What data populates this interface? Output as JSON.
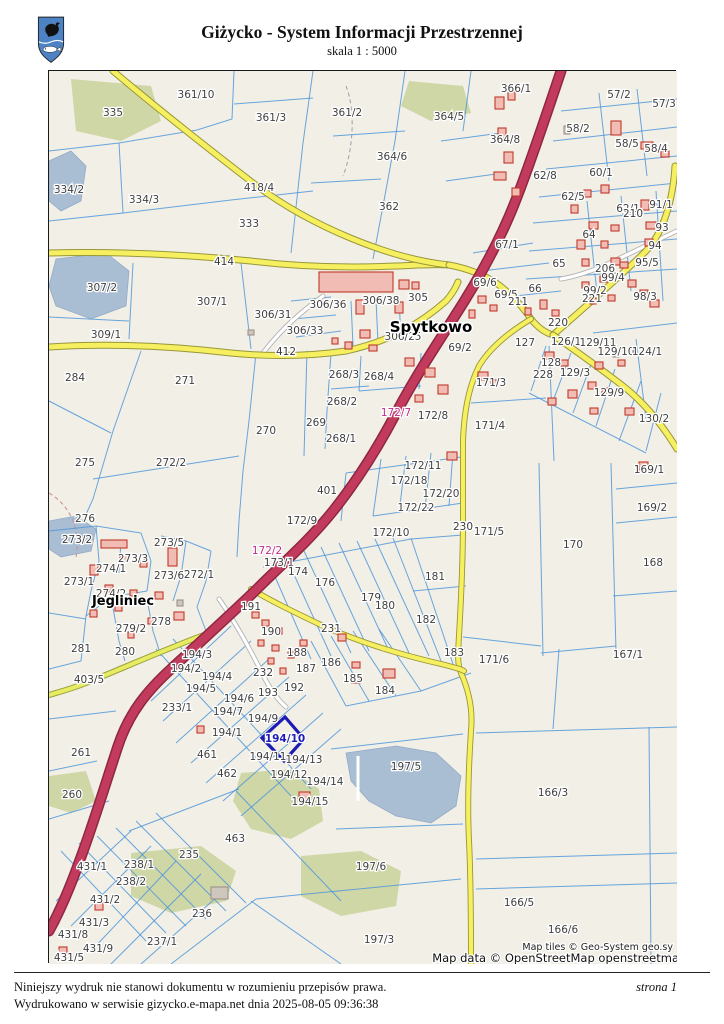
{
  "header": {
    "title": "Giżycko - System Informacji Przestrzennej",
    "scale_label": "skala 1 : 5000"
  },
  "map": {
    "place_labels": [
      [
        "Spytkowo",
        430,
        331
      ],
      [
        "Jegliniec",
        122,
        604
      ]
    ],
    "parcel_labels": [
      [
        "335",
        112,
        115
      ],
      [
        "361/10",
        195,
        97
      ],
      [
        "361/3",
        270,
        120
      ],
      [
        "361/2",
        346,
        115
      ],
      [
        "364/5",
        448,
        119
      ],
      [
        "366/1",
        515,
        91
      ],
      [
        "57/2",
        618,
        97
      ],
      [
        "57/3",
        663,
        106
      ],
      [
        "58/2",
        577,
        131
      ],
      [
        "58/5",
        626,
        146
      ],
      [
        "58/4",
        655,
        151
      ],
      [
        "364/8",
        504,
        142
      ],
      [
        "364/6",
        391,
        159
      ],
      [
        "60/1",
        600,
        175
      ],
      [
        "62/8",
        544,
        178
      ],
      [
        "418/4",
        258,
        190
      ],
      [
        "334/2",
        68,
        192
      ],
      [
        "334/3",
        143,
        202
      ],
      [
        "333",
        248,
        226
      ],
      [
        "362",
        388,
        209
      ],
      [
        "62/5",
        572,
        199
      ],
      [
        "62/1",
        627,
        211
      ],
      [
        "91/1",
        660,
        207
      ],
      [
        "93",
        661,
        230
      ],
      [
        "64",
        588,
        237
      ],
      [
        "67/1",
        506,
        247
      ],
      [
        "94",
        654,
        248
      ],
      [
        "65",
        558,
        266
      ],
      [
        "95/5",
        646,
        265
      ],
      [
        "206",
        604,
        271
      ],
      [
        "99/4",
        612,
        280
      ],
      [
        "99/2",
        594,
        293
      ],
      [
        "221",
        591,
        301
      ],
      [
        "98/3",
        644,
        299
      ],
      [
        "66",
        534,
        291
      ],
      [
        "307/2",
        101,
        290
      ],
      [
        "307/1",
        211,
        304
      ],
      [
        "306/36",
        327,
        307
      ],
      [
        "306/38",
        380,
        303
      ],
      [
        "305",
        417,
        300
      ],
      [
        "306/31",
        272,
        317
      ],
      [
        "306/33",
        304,
        333
      ],
      [
        "306/25",
        402,
        339
      ],
      [
        "69/6",
        484,
        285
      ],
      [
        "69/5",
        505,
        297
      ],
      [
        "69/2",
        459,
        350
      ],
      [
        "309/1",
        105,
        337
      ],
      [
        "284",
        74,
        380
      ],
      [
        "271",
        184,
        383
      ],
      [
        "270",
        265,
        433
      ],
      [
        "275",
        84,
        465
      ],
      [
        "272/2",
        170,
        465
      ],
      [
        "127",
        524,
        345
      ],
      [
        "126/1",
        565,
        344
      ],
      [
        "129/11",
        597,
        345
      ],
      [
        "129/10",
        615,
        354
      ],
      [
        "124/1",
        646,
        354
      ],
      [
        "128",
        550,
        365
      ],
      [
        "228",
        542,
        377
      ],
      [
        "129/3",
        574,
        375
      ],
      [
        "129/9",
        608,
        395
      ],
      [
        "130/2",
        653,
        421
      ],
      [
        "171/3",
        490,
        385
      ],
      [
        "171/4",
        489,
        428
      ],
      [
        "169/1",
        648,
        472
      ],
      [
        "169/2",
        651,
        510
      ],
      [
        "168",
        652,
        565
      ],
      [
        "170",
        572,
        547
      ],
      [
        "171/5",
        488,
        534
      ],
      [
        "171/6",
        493,
        662
      ],
      [
        "167/1",
        627,
        657
      ],
      [
        "268/3",
        343,
        377
      ],
      [
        "268/4",
        378,
        379
      ],
      [
        "268/2",
        341,
        404
      ],
      [
        "269",
        315,
        425
      ],
      [
        "268/1",
        340,
        441
      ],
      [
        "172/8",
        432,
        418
      ],
      [
        "172/11",
        422,
        468
      ],
      [
        "172/18",
        408,
        483
      ],
      [
        "172/20",
        440,
        496
      ],
      [
        "172/22",
        415,
        510
      ],
      [
        "172/10",
        390,
        535
      ],
      [
        "172/9",
        301,
        523
      ],
      [
        "401",
        326,
        493
      ],
      [
        "173/1",
        278,
        565
      ],
      [
        "174",
        297,
        574
      ],
      [
        "176",
        324,
        585
      ],
      [
        "179",
        370,
        600
      ],
      [
        "180",
        384,
        608
      ],
      [
        "181",
        434,
        579
      ],
      [
        "182",
        425,
        622
      ],
      [
        "183",
        453,
        655
      ],
      [
        "184",
        384,
        693
      ],
      [
        "185",
        352,
        681
      ],
      [
        "186",
        330,
        665
      ],
      [
        "187",
        305,
        671
      ],
      [
        "188",
        296,
        655
      ],
      [
        "190",
        270,
        634
      ],
      [
        "191",
        250,
        609
      ],
      [
        "192",
        293,
        690
      ],
      [
        "193",
        267,
        695
      ],
      [
        "276",
        84,
        521
      ],
      [
        "273/2",
        76,
        542
      ],
      [
        "273/5",
        168,
        545
      ],
      [
        "273/3",
        132,
        561
      ],
      [
        "274/1",
        110,
        571
      ],
      [
        "273/1",
        78,
        584
      ],
      [
        "273/6",
        168,
        578
      ],
      [
        "272/1",
        198,
        577
      ],
      [
        "274/2",
        110,
        596
      ],
      [
        "278",
        160,
        624
      ],
      [
        "279/2",
        130,
        631
      ],
      [
        "281",
        80,
        651
      ],
      [
        "280",
        124,
        654
      ],
      [
        "261",
        80,
        755
      ],
      [
        "260",
        71,
        797
      ],
      [
        "233/1",
        176,
        710
      ],
      [
        "194/3",
        196,
        657
      ],
      [
        "194/2",
        185,
        671
      ],
      [
        "194/4",
        216,
        679
      ],
      [
        "194/5",
        200,
        691
      ],
      [
        "194/6",
        238,
        701
      ],
      [
        "194/7",
        227,
        714
      ],
      [
        "194/1",
        226,
        735
      ],
      [
        "194/9",
        262,
        721
      ],
      [
        "194/11",
        267,
        759
      ],
      [
        "194/13",
        303,
        762
      ],
      [
        "194/12",
        288,
        777
      ],
      [
        "194/14",
        324,
        784
      ],
      [
        "194/15",
        309,
        804
      ],
      [
        "461",
        206,
        757
      ],
      [
        "462",
        226,
        776
      ],
      [
        "463",
        234,
        841
      ],
      [
        "235",
        188,
        857
      ],
      [
        "238/1",
        138,
        867
      ],
      [
        "238/2",
        130,
        884
      ],
      [
        "431/1",
        91,
        869
      ],
      [
        "431/2",
        104,
        902
      ],
      [
        "431/3",
        93,
        925
      ],
      [
        "431/8",
        72,
        937
      ],
      [
        "431/9",
        97,
        951
      ],
      [
        "431/5",
        68,
        960
      ],
      [
        "236",
        201,
        916
      ],
      [
        "237/1",
        161,
        944
      ],
      [
        "197/5",
        405,
        769
      ],
      [
        "197/6",
        370,
        869
      ],
      [
        "197/3",
        378,
        942
      ],
      [
        "166/3",
        552,
        795
      ],
      [
        "166/5",
        518,
        905
      ],
      [
        "166/6",
        562,
        932
      ]
    ],
    "road_labels": [
      [
        "414",
        223,
        264
      ],
      [
        "412",
        285,
        354
      ],
      [
        "211",
        517,
        304
      ],
      [
        "210",
        632,
        216
      ],
      [
        "220",
        557,
        325
      ],
      [
        "230",
        462,
        529
      ],
      [
        "231",
        330,
        631
      ],
      [
        "232",
        262,
        675
      ],
      [
        "403/5",
        88,
        682
      ]
    ],
    "highlight_labels": [
      [
        "172/7",
        395,
        415
      ],
      [
        "172/2",
        266,
        553
      ]
    ],
    "selected_parcel_label": [
      "194/10",
      284,
      741
    ],
    "attribution": {
      "line1": "Map tiles © Geo-System geo.sy",
      "line2": "Map data © OpenStreetMap openstreetma"
    },
    "colors": {
      "background": "#f2efe7",
      "parcel_line": "#4f97d9",
      "major_road": "#c23a5c",
      "secondary_road": "#f6ef5f",
      "building": "#f0bcb4",
      "building_outline": "#c0392b",
      "water": "#a9bdd3",
      "greenery": "#ccd4a0",
      "selection": "#1c1cb4",
      "highlight_text": "#c12a8d"
    }
  },
  "footer": {
    "line1": "Niniejszy wydruk nie stanowi dokumentu w rozumieniu przepisów prawa.",
    "line2": "Wydrukowano w serwisie gizycko.e-mapa.net dnia 2025-08-05 09:36:38",
    "page": "strona 1"
  }
}
